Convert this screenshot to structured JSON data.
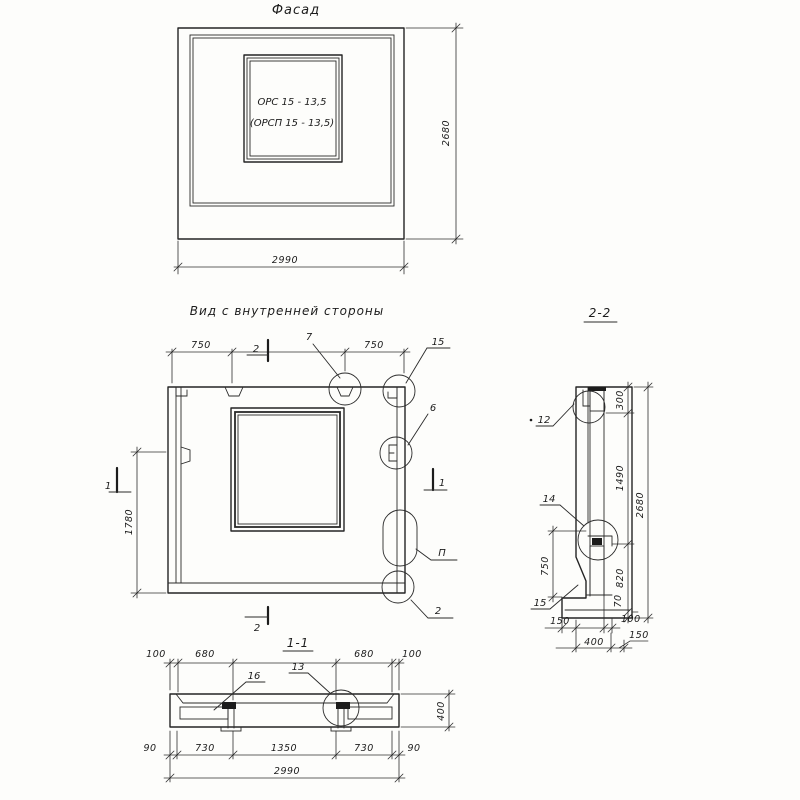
{
  "facade": {
    "title": "Фасад",
    "stamp_line1": "ОРС 15 - 13,5",
    "stamp_line2": "(ОРСП 15 - 13,5)",
    "dim_width": "2990",
    "dim_height": "2680"
  },
  "inner": {
    "title": "Вид с внутренней стороны",
    "dim_top_left": "750",
    "dim_top_right": "750",
    "dim_left_height": "1780",
    "callout_top": "7",
    "callout_top_right": "15",
    "callout_right": "6",
    "callout_detail": "П",
    "callout_bottom": "2",
    "marker_top": "2",
    "marker_bottom": "2",
    "marker_left": "1",
    "marker_right": "1"
  },
  "section11": {
    "title": "1-1",
    "dim_top": [
      "100",
      "680",
      "680",
      "100"
    ],
    "callout_left": "16",
    "callout_right": "13",
    "dim_height": "400",
    "dim_bottom": [
      "90",
      "730",
      "1350",
      "730",
      "90"
    ],
    "dim_overall": "2990"
  },
  "section22": {
    "title": "2-2",
    "callout_top": "12",
    "callout_mid": "14",
    "callout_bottom": "15",
    "dim_right": [
      "300",
      "1490",
      "820",
      "70"
    ],
    "dim_overall": "2680",
    "dim_left": "750",
    "dim_bottom_row1": [
      "150",
      "100"
    ],
    "dim_bottom_row2": [
      "400",
      "150"
    ]
  }
}
